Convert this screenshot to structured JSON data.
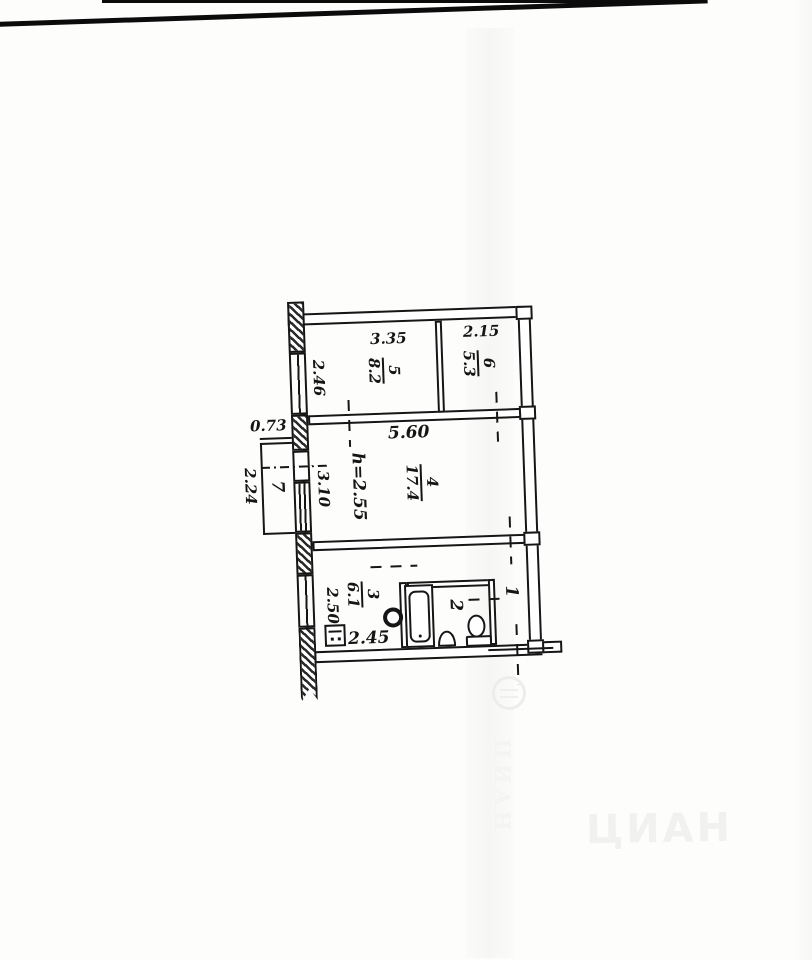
{
  "rooms": {
    "r5": {
      "number": "5",
      "area": "8.2"
    },
    "r6": {
      "number": "6",
      "area": "5.3"
    },
    "r4": {
      "number": "4",
      "area": "17.4"
    },
    "r3": {
      "number": "3",
      "area": "6.1"
    },
    "r2": {
      "number": "2"
    },
    "r1": {
      "number": "1"
    },
    "r7": {
      "number": "7"
    }
  },
  "dimensions": {
    "room5_width": "3.35",
    "room6_width": "2.15",
    "room5_depth": "2.46",
    "room4_width": "5.60",
    "ceiling_height": "h=2.55",
    "room4_depth": "3.10",
    "balcony_width": "0.73",
    "balcony_depth": "2.24",
    "room3_depth": "2.50",
    "room3_width": "2.45"
  },
  "watermark": {
    "brand": "ЦИАН"
  },
  "colors": {
    "ink": "#161616",
    "paper": "#fdfdfc",
    "watermark": "#f1f1f0"
  }
}
